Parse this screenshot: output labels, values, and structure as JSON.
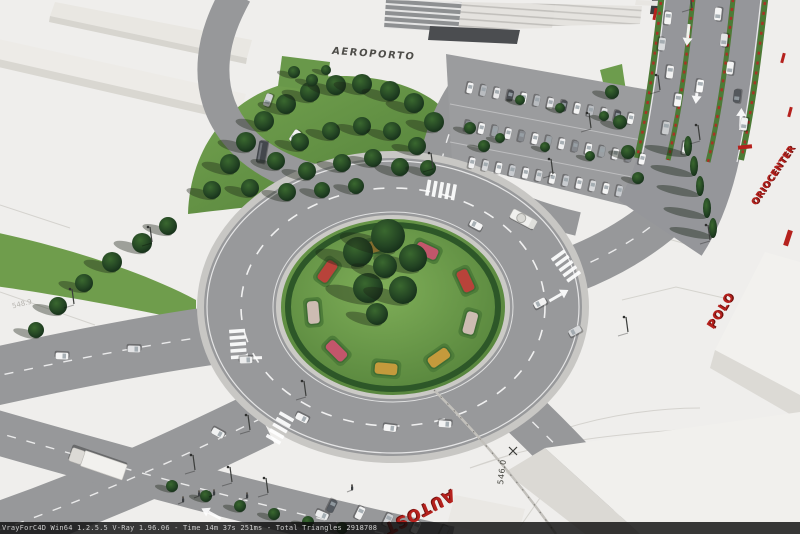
{
  "image": {
    "width": 800,
    "height": 534
  },
  "status_bar": {
    "text": "VrayForC4D Win64 1.2.5.5 V-Ray 1.96.06 - Time 14m 37s 251ms - Total Triangles 2918708"
  },
  "scene": {
    "terminal_sign": "AEROPORTO",
    "red_labels": [
      {
        "id": "oriocenter",
        "text": "ORIOCENTER"
      },
      {
        "id": "polo",
        "text": "POLO"
      },
      {
        "id": "autostrada",
        "text": "AUTOST"
      }
    ],
    "survey_labels": [
      {
        "text": "546.0"
      },
      {
        "text": "548.9"
      }
    ],
    "colors": {
      "label_red": "#b5211d",
      "asphalt": "#97989a",
      "grass": "#5d8c3f",
      "tree_dark": "#1c3a20",
      "cad_white": "#efeeec"
    }
  }
}
